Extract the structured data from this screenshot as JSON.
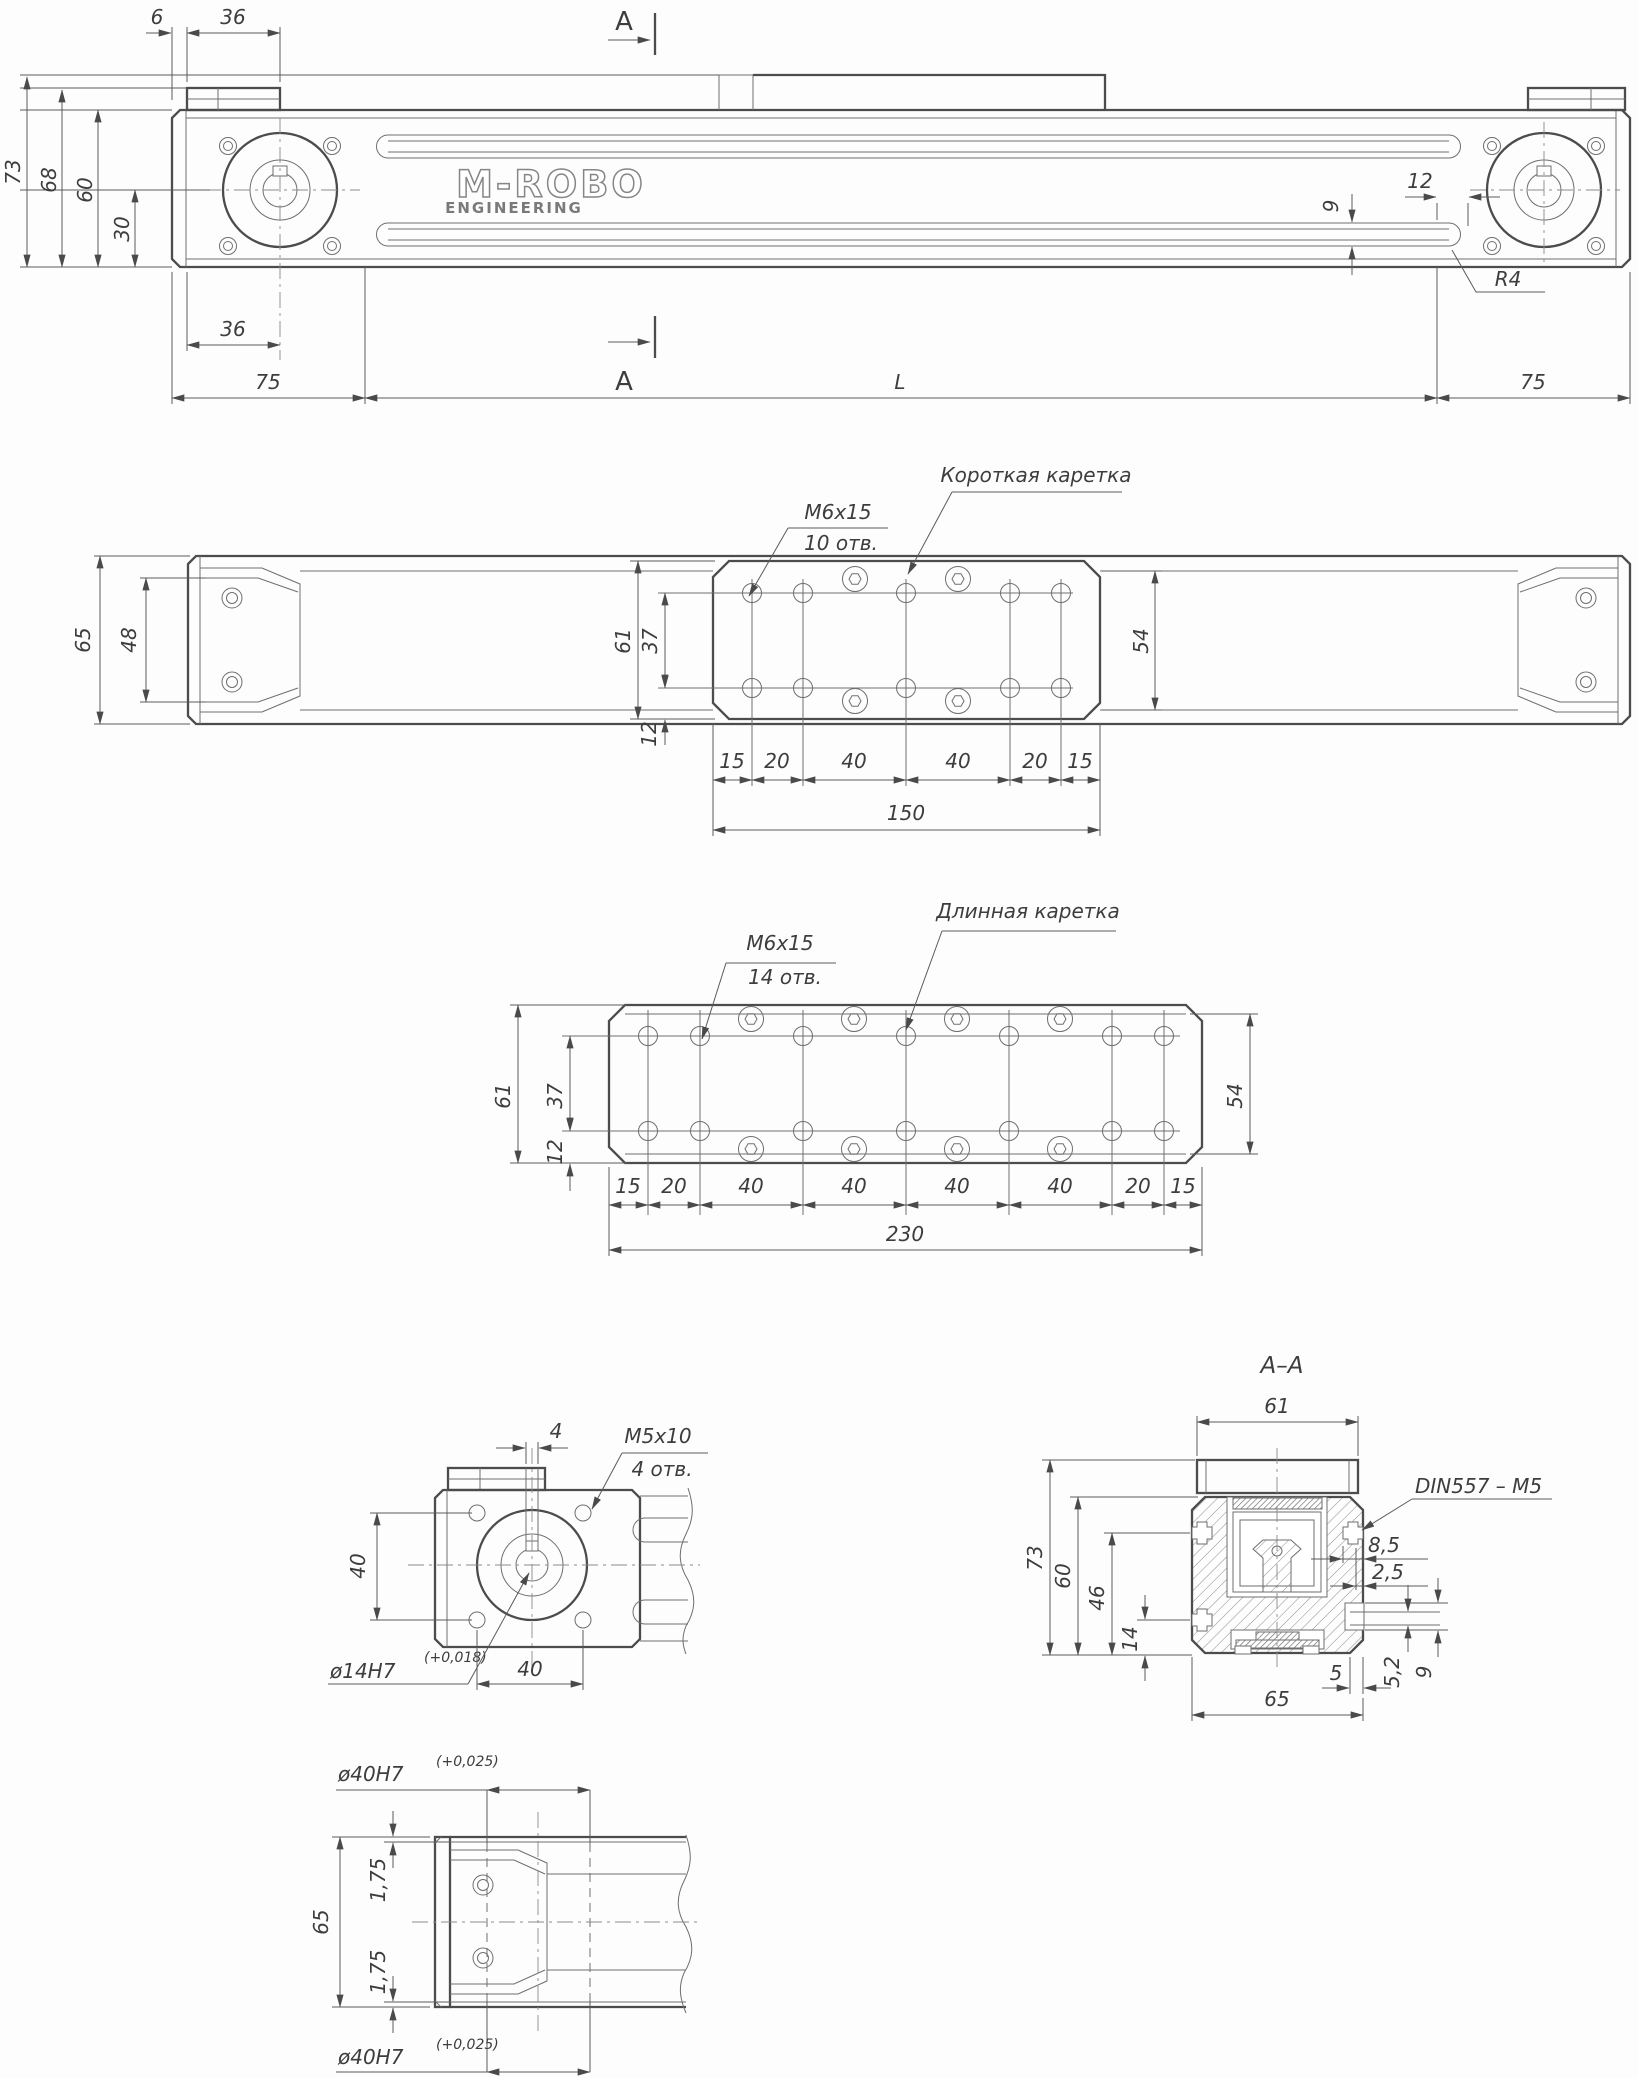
{
  "drawing": {
    "brand": {
      "name": "M-ROBO",
      "subtitle": "ENGINEERING"
    },
    "section_letter": "A",
    "front": {
      "dims": {
        "top_offset": "6",
        "top_width": "36",
        "height_total": "73",
        "height_body": "68",
        "height_rail": "60",
        "height_center": "30",
        "pulley_offset": "36",
        "end_left": "75",
        "length": "L",
        "end_right": "75",
        "slot_offset": "12",
        "belt_height": "9",
        "radius": "R4"
      }
    },
    "plan_short": {
      "thread": "M6x15",
      "holes": "10 отв.",
      "carriage": "Короткая каретка",
      "dims": {
        "width_total": "65",
        "cap_width": "48",
        "carriage_width": "61",
        "rows": "37",
        "edge": "12",
        "track": "54",
        "total": "150",
        "chain": [
          "15",
          "20",
          "40",
          "40",
          "20",
          "15"
        ]
      }
    },
    "plan_long": {
      "thread": "M6x15",
      "holes": "14 отв.",
      "carriage": "Длинная каретка",
      "dims": {
        "carriage_width": "61",
        "rows": "37",
        "edge": "12",
        "track": "54",
        "total": "230",
        "chain": [
          "15",
          "20",
          "40",
          "40",
          "40",
          "40",
          "20",
          "15"
        ]
      }
    },
    "motor_end": {
      "thread": "M5x10",
      "holes": "4 отв.",
      "bore": "ø14H7",
      "bore_tol": "(+0,018)",
      "dims": {
        "key": "4",
        "square_v": "40",
        "square_h": "40"
      }
    },
    "section": {
      "title": "A–A",
      "nut": "DIN557 – M5",
      "dims": {
        "width_top": "61",
        "height_total": "73",
        "height_body": "60",
        "nut_upper": "46",
        "nut_lower": "14",
        "slot_depth": "8,5",
        "lip": "2,5",
        "belt": "5,2",
        "slot": "9",
        "wall": "5",
        "width_body": "65"
      }
    },
    "idler_end": {
      "bore": "ø40H7",
      "bore_tol": "(+0,025)",
      "dims": {
        "height": "65",
        "lip_top": "1,75",
        "lip_bottom": "1,75"
      }
    }
  }
}
